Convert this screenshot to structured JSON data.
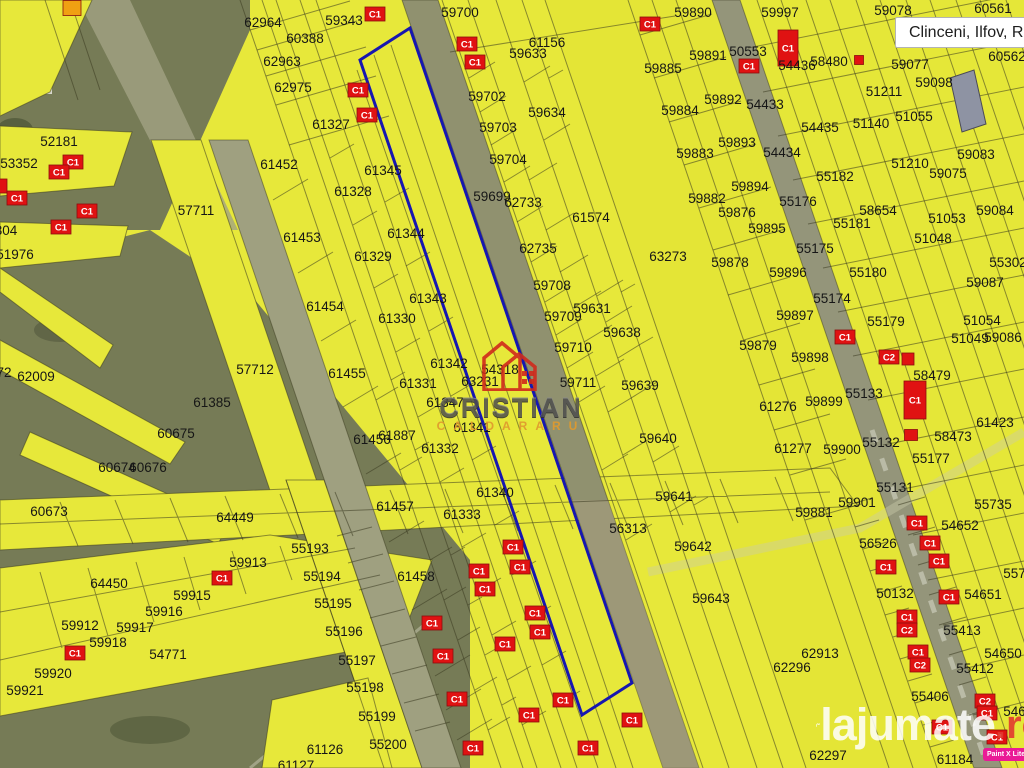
{
  "location_box": {
    "label": "Clinceni, Ilfov, ROU"
  },
  "watermarks": {
    "agency_name": "CRISTIAN",
    "agency_subname": "CALDARARU",
    "site_name": "lajumate",
    "site_tld": ".ro",
    "app_badge": "Paint X Lite"
  },
  "colors": {
    "map-base": "#e7e83a",
    "map-olive": "#767b56",
    "road": "#90916f",
    "line": "#3a3a20",
    "highlight": "#1717b0",
    "marker-red": "#e01212",
    "marker-orange": "#f0a012",
    "site-accent": "#e23b30",
    "badge-bg": "#ea1a96"
  },
  "map": {
    "highlight_polygon": "410,28 632,683 582,715 360,60",
    "parcels": [
      [
        "62964",
        263,
        23
      ],
      [
        "60388",
        305,
        39
      ],
      [
        "62963",
        282,
        62
      ],
      [
        "62975",
        293,
        88
      ],
      [
        "59343",
        344,
        21
      ],
      [
        "61327",
        331,
        125
      ],
      [
        "52181",
        59,
        142
      ],
      [
        "53352",
        19,
        164
      ],
      [
        "61452",
        279,
        165
      ],
      [
        "57711",
        196,
        211
      ],
      [
        "61453",
        302,
        238
      ],
      [
        "51976",
        15,
        255
      ],
      [
        "304",
        6,
        231
      ],
      [
        "59700",
        460,
        13
      ],
      [
        "61156",
        547,
        43
      ],
      [
        "59633",
        528,
        54
      ],
      [
        "59702",
        487,
        97
      ],
      [
        "59634",
        547,
        113
      ],
      [
        "59703",
        498,
        128
      ],
      [
        "59704",
        508,
        160
      ],
      [
        "59699",
        492,
        197
      ],
      [
        "62733",
        523,
        203
      ],
      [
        "61574",
        591,
        218
      ],
      [
        "62735",
        538,
        249
      ],
      [
        "61345",
        383,
        171
      ],
      [
        "61328",
        353,
        192
      ],
      [
        "61344",
        406,
        234
      ],
      [
        "61329",
        373,
        257
      ],
      [
        "59890",
        693,
        13
      ],
      [
        "59997",
        780,
        13
      ],
      [
        "59078",
        893,
        11
      ],
      [
        "60561",
        993,
        9
      ],
      [
        "59885",
        663,
        69
      ],
      [
        "59891",
        708,
        56
      ],
      [
        "50553",
        748,
        52
      ],
      [
        "54436",
        797,
        66
      ],
      [
        "58480",
        829,
        62
      ],
      [
        "59077",
        910,
        65
      ],
      [
        "60562",
        1007,
        57
      ],
      [
        "59892",
        723,
        100
      ],
      [
        "54433",
        765,
        105
      ],
      [
        "51211",
        884,
        92
      ],
      [
        "59098",
        934,
        83
      ],
      [
        "59884",
        680,
        111
      ],
      [
        "54435",
        820,
        128
      ],
      [
        "51140",
        871,
        124
      ],
      [
        "51055",
        914,
        117
      ],
      [
        "59893",
        737,
        143
      ],
      [
        "59883",
        695,
        154
      ],
      [
        "54434",
        782,
        153
      ],
      [
        "51210",
        910,
        164
      ],
      [
        "59083",
        976,
        155
      ],
      [
        "59075",
        948,
        174
      ],
      [
        "55182",
        835,
        177
      ],
      [
        "59894",
        750,
        187
      ],
      [
        "59882",
        707,
        199
      ],
      [
        "55176",
        798,
        202
      ],
      [
        "58654",
        878,
        211
      ],
      [
        "59084",
        995,
        211
      ],
      [
        "59876",
        737,
        213
      ],
      [
        "55181",
        852,
        224
      ],
      [
        "51053",
        947,
        219
      ],
      [
        "59895",
        767,
        229
      ],
      [
        "51048",
        933,
        239
      ],
      [
        "55175",
        815,
        249
      ],
      [
        "72",
        4,
        373
      ],
      [
        "62009",
        36,
        377
      ],
      [
        "57712",
        255,
        370
      ],
      [
        "61385",
        212,
        403
      ],
      [
        "60675",
        176,
        434
      ],
      [
        "60674",
        117,
        468
      ],
      [
        "60676",
        148,
        468
      ],
      [
        "61454",
        325,
        307
      ],
      [
        "60673",
        49,
        512
      ],
      [
        "63273",
        668,
        257
      ],
      [
        "61343",
        428,
        299
      ],
      [
        "61330",
        397,
        319
      ],
      [
        "59708",
        552,
        286
      ],
      [
        "59709",
        563,
        317
      ],
      [
        "59631",
        592,
        309
      ],
      [
        "59638",
        622,
        333
      ],
      [
        "61342",
        449,
        364
      ],
      [
        "59710",
        573,
        348
      ],
      [
        "61455",
        347,
        374
      ],
      [
        "61331",
        418,
        384
      ],
      [
        "63231",
        480,
        382
      ],
      [
        "54318",
        500,
        370
      ],
      [
        "59711",
        578,
        383
      ],
      [
        "59639",
        640,
        386
      ],
      [
        "61347",
        445,
        403
      ],
      [
        "61456",
        372,
        440
      ],
      [
        "61887",
        397,
        436
      ],
      [
        "61341",
        472,
        428
      ],
      [
        "61332",
        440,
        449
      ],
      [
        "59640",
        658,
        439
      ],
      [
        "61340",
        495,
        493
      ],
      [
        "61457",
        395,
        507
      ],
      [
        "59641",
        674,
        497
      ],
      [
        "59878",
        730,
        263
      ],
      [
        "55302",
        1008,
        263
      ],
      [
        "59896",
        788,
        273
      ],
      [
        "55180",
        868,
        273
      ],
      [
        "59087",
        985,
        283
      ],
      [
        "55174",
        832,
        299
      ],
      [
        "59897",
        795,
        316
      ],
      [
        "55179",
        886,
        322
      ],
      [
        "51054",
        982,
        321
      ],
      [
        "51049",
        970,
        339
      ],
      [
        "59086",
        1003,
        338
      ],
      [
        "59879",
        758,
        346
      ],
      [
        "59898",
        810,
        358
      ],
      [
        "58479",
        932,
        376
      ],
      [
        "61276",
        778,
        407
      ],
      [
        "55133",
        864,
        394
      ],
      [
        "59899",
        824,
        402
      ],
      [
        "61423",
        995,
        423
      ],
      [
        "59900",
        842,
        450
      ],
      [
        "55132",
        881,
        443
      ],
      [
        "58473",
        953,
        437
      ],
      [
        "61277",
        793,
        449
      ],
      [
        "55177",
        931,
        459
      ],
      [
        "55131",
        895,
        488
      ],
      [
        "64449",
        235,
        518
      ],
      [
        "55193",
        310,
        549
      ],
      [
        "59913",
        248,
        563
      ],
      [
        "55194",
        322,
        577
      ],
      [
        "64450",
        109,
        584
      ],
      [
        "59915",
        192,
        596
      ],
      [
        "55195",
        333,
        604
      ],
      [
        "59916",
        164,
        612
      ],
      [
        "59912",
        80,
        626
      ],
      [
        "59917",
        135,
        628
      ],
      [
        "59918",
        108,
        643
      ],
      [
        "54771",
        168,
        655
      ],
      [
        "59920",
        53,
        674
      ],
      [
        "59921",
        25,
        691
      ],
      [
        "61126",
        325,
        750
      ],
      [
        "61127",
        296,
        766
      ],
      [
        "61333",
        462,
        515
      ],
      [
        "56313",
        628,
        529
      ],
      [
        "61458",
        416,
        577
      ],
      [
        "55196",
        344,
        632
      ],
      [
        "55197",
        357,
        661
      ],
      [
        "55198",
        365,
        688
      ],
      [
        "55199",
        377,
        717
      ],
      [
        "55200",
        388,
        745
      ],
      [
        "59881",
        814,
        513
      ],
      [
        "54652",
        960,
        526
      ],
      [
        "56526",
        878,
        544
      ],
      [
        "59642",
        693,
        547
      ],
      [
        "50132",
        895,
        594
      ],
      [
        "54651",
        983,
        595
      ],
      [
        "55734",
        1022,
        574
      ],
      [
        "55413",
        962,
        631
      ],
      [
        "54650",
        1003,
        654
      ],
      [
        "55412",
        975,
        669
      ],
      [
        "55406",
        930,
        697
      ],
      [
        "54649",
        1022,
        712
      ],
      [
        "62913",
        820,
        654
      ],
      [
        "62296",
        792,
        668
      ],
      [
        "62297",
        828,
        756
      ],
      [
        "61184",
        955,
        760
      ],
      [
        "59643",
        711,
        599
      ],
      [
        "59901",
        857,
        503
      ],
      [
        "55735",
        993,
        505
      ]
    ],
    "buildings": [
      {
        "t": "C1",
        "x": 375,
        "y": 14
      },
      {
        "t": "C1",
        "x": 650,
        "y": 24
      },
      {
        "t": "C1",
        "x": 467,
        "y": 44
      },
      {
        "t": "C1",
        "x": 475,
        "y": 62
      },
      {
        "t": "C1",
        "x": 358,
        "y": 90
      },
      {
        "t": "C1",
        "x": 367,
        "y": 115
      },
      {
        "t": "C1",
        "x": 788,
        "y": 48,
        "w": 20,
        "h": 36
      },
      {
        "t": "C1",
        "x": 749,
        "y": 66
      },
      {
        "t": "",
        "x": 859,
        "y": 60,
        "w": 9,
        "h": 9
      },
      {
        "t": "",
        "x": 72,
        "y": 8,
        "w": 18,
        "h": 15,
        "c": "#f0a012"
      },
      {
        "t": "C1",
        "x": 73,
        "y": 162
      },
      {
        "t": "C1",
        "x": 59,
        "y": 172
      },
      {
        "t": "",
        "x": 2,
        "y": 186,
        "w": 10,
        "h": 14
      },
      {
        "t": "C1",
        "x": 17,
        "y": 198
      },
      {
        "t": "C1",
        "x": 87,
        "y": 211
      },
      {
        "t": "C1",
        "x": 61,
        "y": 227
      },
      {
        "t": "C1",
        "x": 845,
        "y": 337
      },
      {
        "t": "C2",
        "x": 889,
        "y": 357
      },
      {
        "t": "",
        "x": 908,
        "y": 359,
        "w": 12,
        "h": 12
      },
      {
        "t": "C1",
        "x": 915,
        "y": 400,
        "w": 22,
        "h": 38
      },
      {
        "t": "",
        "x": 911,
        "y": 435,
        "w": 13,
        "h": 11
      },
      {
        "t": "C1",
        "x": 222,
        "y": 578
      },
      {
        "t": "C1",
        "x": 75,
        "y": 653
      },
      {
        "t": "C1",
        "x": 513,
        "y": 547
      },
      {
        "t": "C1",
        "x": 520,
        "y": 567
      },
      {
        "t": "C1",
        "x": 479,
        "y": 571
      },
      {
        "t": "C1",
        "x": 485,
        "y": 589
      },
      {
        "t": "C1",
        "x": 535,
        "y": 613
      },
      {
        "t": "C1",
        "x": 432,
        "y": 623
      },
      {
        "t": "C1",
        "x": 540,
        "y": 632
      },
      {
        "t": "C1",
        "x": 505,
        "y": 644
      },
      {
        "t": "C1",
        "x": 443,
        "y": 656
      },
      {
        "t": "C1",
        "x": 457,
        "y": 699
      },
      {
        "t": "C1",
        "x": 529,
        "y": 715
      },
      {
        "t": "C1",
        "x": 563,
        "y": 700
      },
      {
        "t": "C1",
        "x": 473,
        "y": 748
      },
      {
        "t": "C1",
        "x": 588,
        "y": 748
      },
      {
        "t": "C1",
        "x": 632,
        "y": 720
      },
      {
        "t": "C1",
        "x": 917,
        "y": 523
      },
      {
        "t": "C1",
        "x": 930,
        "y": 543
      },
      {
        "t": "C1",
        "x": 939,
        "y": 561
      },
      {
        "t": "C1",
        "x": 886,
        "y": 567
      },
      {
        "t": "C1",
        "x": 949,
        "y": 597
      },
      {
        "t": "C1",
        "x": 907,
        "y": 617
      },
      {
        "t": "C2",
        "x": 907,
        "y": 630
      },
      {
        "t": "C1",
        "x": 918,
        "y": 652
      },
      {
        "t": "C2",
        "x": 920,
        "y": 665
      },
      {
        "t": "C2",
        "x": 985,
        "y": 701
      },
      {
        "t": "C1",
        "x": 987,
        "y": 713
      },
      {
        "t": "C1",
        "x": 942,
        "y": 727
      },
      {
        "t": "C1",
        "x": 997,
        "y": 737
      }
    ]
  }
}
